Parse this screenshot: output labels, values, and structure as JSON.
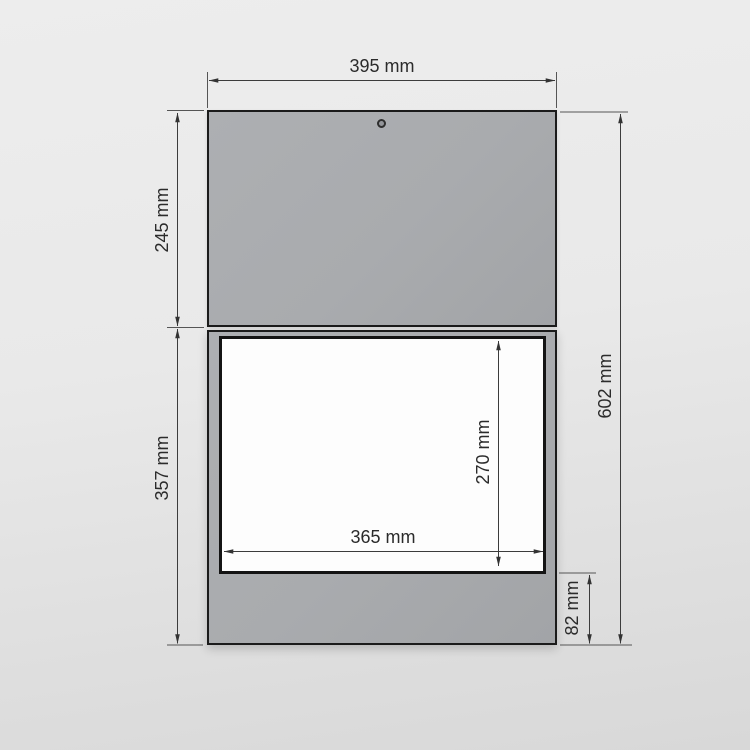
{
  "drawing": {
    "dims": {
      "overall_width": "395 mm",
      "top_section_height": "245 mm",
      "bottom_section_height": "357 mm",
      "overall_height": "602 mm",
      "opening_width": "365 mm",
      "opening_height": "270 mm",
      "base_height": "82 mm"
    },
    "colors": {
      "background_top": "#ededed",
      "background_bottom": "#d8d8d8",
      "panel": "#a9abae",
      "outline": "#1b1b1b",
      "opening": "#fdfdfd",
      "dimension_line": "#3c3c3c",
      "label_text": "#2b2b2b"
    }
  }
}
